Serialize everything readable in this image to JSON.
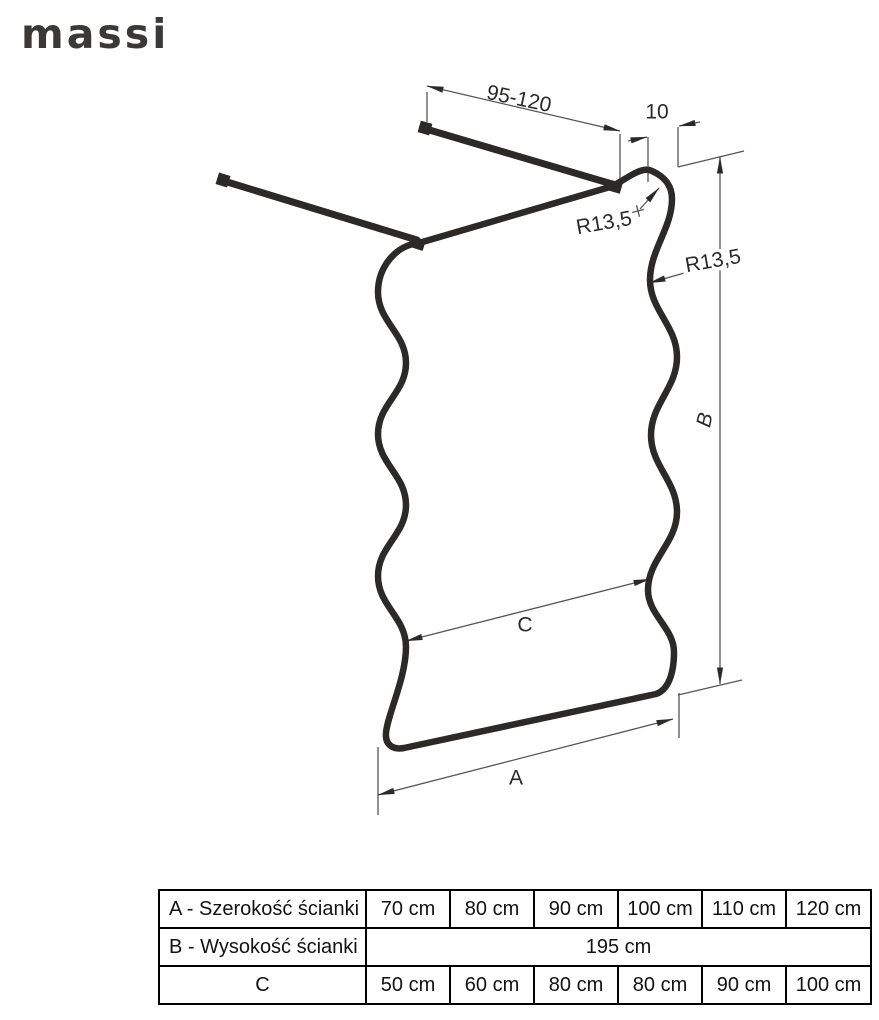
{
  "brand": {
    "logo": "massi"
  },
  "diagram": {
    "labels": {
      "bar_range": "95-120",
      "gap": "10",
      "radius_top": "R13,5",
      "radius_side": "R13,5",
      "dim_a": "A",
      "dim_b": "B",
      "dim_c": "C"
    },
    "colors": {
      "outline": "#2b2a29",
      "dim_line": "#565656"
    }
  },
  "table": {
    "rows": [
      {
        "label": "A - Szerokość ścianki",
        "values": [
          "70 cm",
          "80 cm",
          "90 cm",
          "100 cm",
          "110 cm",
          "120 cm"
        ]
      },
      {
        "label": "B - Wysokość ścianki",
        "values": [
          "195 cm"
        ]
      },
      {
        "label": "C",
        "values": [
          "50 cm",
          "60 cm",
          "80 cm",
          "80 cm",
          "90 cm",
          "100 cm"
        ]
      }
    ]
  }
}
